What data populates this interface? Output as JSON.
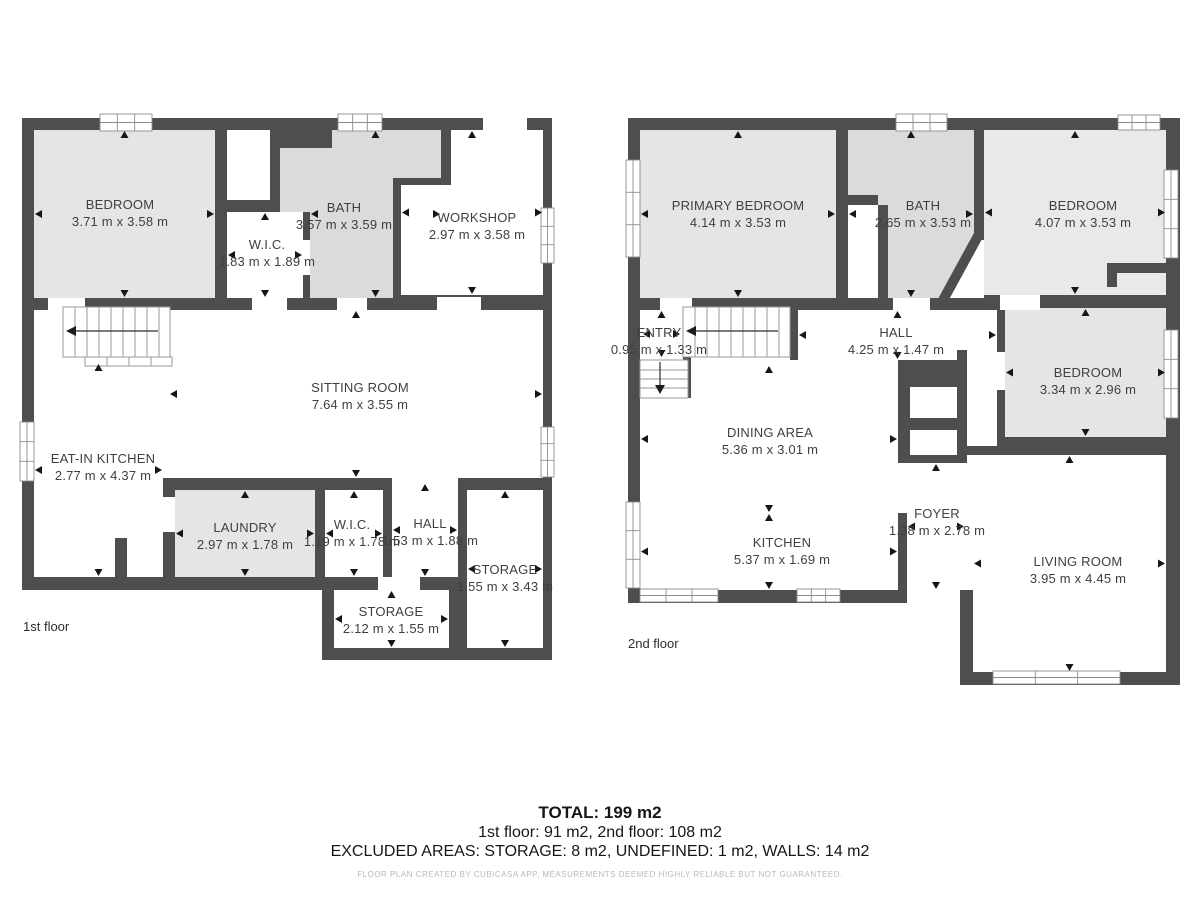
{
  "colors": {
    "wall": "#4e4e4e",
    "room_light": "#e5e5e5",
    "room_mid": "#dbdbdb",
    "footer": "#b9b9b9"
  },
  "floor1": {
    "label": "1st floor",
    "rooms": {
      "bedroom": {
        "name": "BEDROOM",
        "dims": "3.71 m x 3.58 m"
      },
      "wic_upper": {
        "name": "W.I.C.",
        "dims": "1.83 m x 1.89 m"
      },
      "bath": {
        "name": "BATH",
        "dims": "3.57 m x 3.59 m"
      },
      "workshop": {
        "name": "WORKSHOP",
        "dims": "2.97 m x 3.58 m"
      },
      "sitting_room": {
        "name": "SITTING ROOM",
        "dims": "7.64 m x 3.55 m"
      },
      "eat_in_kitchen": {
        "name": "EAT-IN KITCHEN",
        "dims": "2.77 m x 4.37 m"
      },
      "laundry": {
        "name": "LAUNDRY",
        "dims": "2.97 m x 1.78 m"
      },
      "wic_lower": {
        "name": "W.I.C.",
        "dims": "1.19 m x 1.78 m"
      },
      "hall": {
        "name": "HALL",
        "dims": "1.53 m x 1.88 m"
      },
      "storage_right": {
        "name": "STORAGE",
        "dims": "1.55 m x 3.43 m"
      },
      "storage_bottom": {
        "name": "STORAGE",
        "dims": "2.12 m x 1.55 m"
      }
    }
  },
  "floor2": {
    "label": "2nd floor",
    "rooms": {
      "primary_bedroom": {
        "name": "PRIMARY BEDROOM",
        "dims": "4.14 m x 3.53 m"
      },
      "bath": {
        "name": "BATH",
        "dims": "2.65 m x 3.53 m"
      },
      "bedroom_top_right": {
        "name": "BEDROOM",
        "dims": "4.07 m x 3.53 m"
      },
      "entry": {
        "name": "ENTRY",
        "dims": "0.95 m x 1.33 m"
      },
      "hall": {
        "name": "HALL",
        "dims": "4.25 m x 1.47 m"
      },
      "bedroom_right": {
        "name": "BEDROOM",
        "dims": "3.34 m x 2.96 m"
      },
      "dining_area": {
        "name": "DINING AREA",
        "dims": "5.36 m x 3.01 m"
      },
      "kitchen": {
        "name": "KITCHEN",
        "dims": "5.37 m x 1.69 m"
      },
      "foyer": {
        "name": "FOYER",
        "dims": "1.38 m x 2.78 m"
      },
      "living_room": {
        "name": "LIVING ROOM",
        "dims": "3.95 m x 4.45 m"
      }
    }
  },
  "summary": {
    "total": "TOTAL: 199 m2",
    "floors": "1st floor: 91 m2, 2nd floor: 108 m2",
    "excluded": "EXCLUDED AREAS: STORAGE: 8 m2, UNDEFINED: 1 m2, WALLS: 14 m2"
  },
  "footer_note": "FLOOR PLAN CREATED BY CUBICASA APP, MEASUREMENTS DEEMED HIGHLY RELIABLE BUT NOT GUARANTEED."
}
